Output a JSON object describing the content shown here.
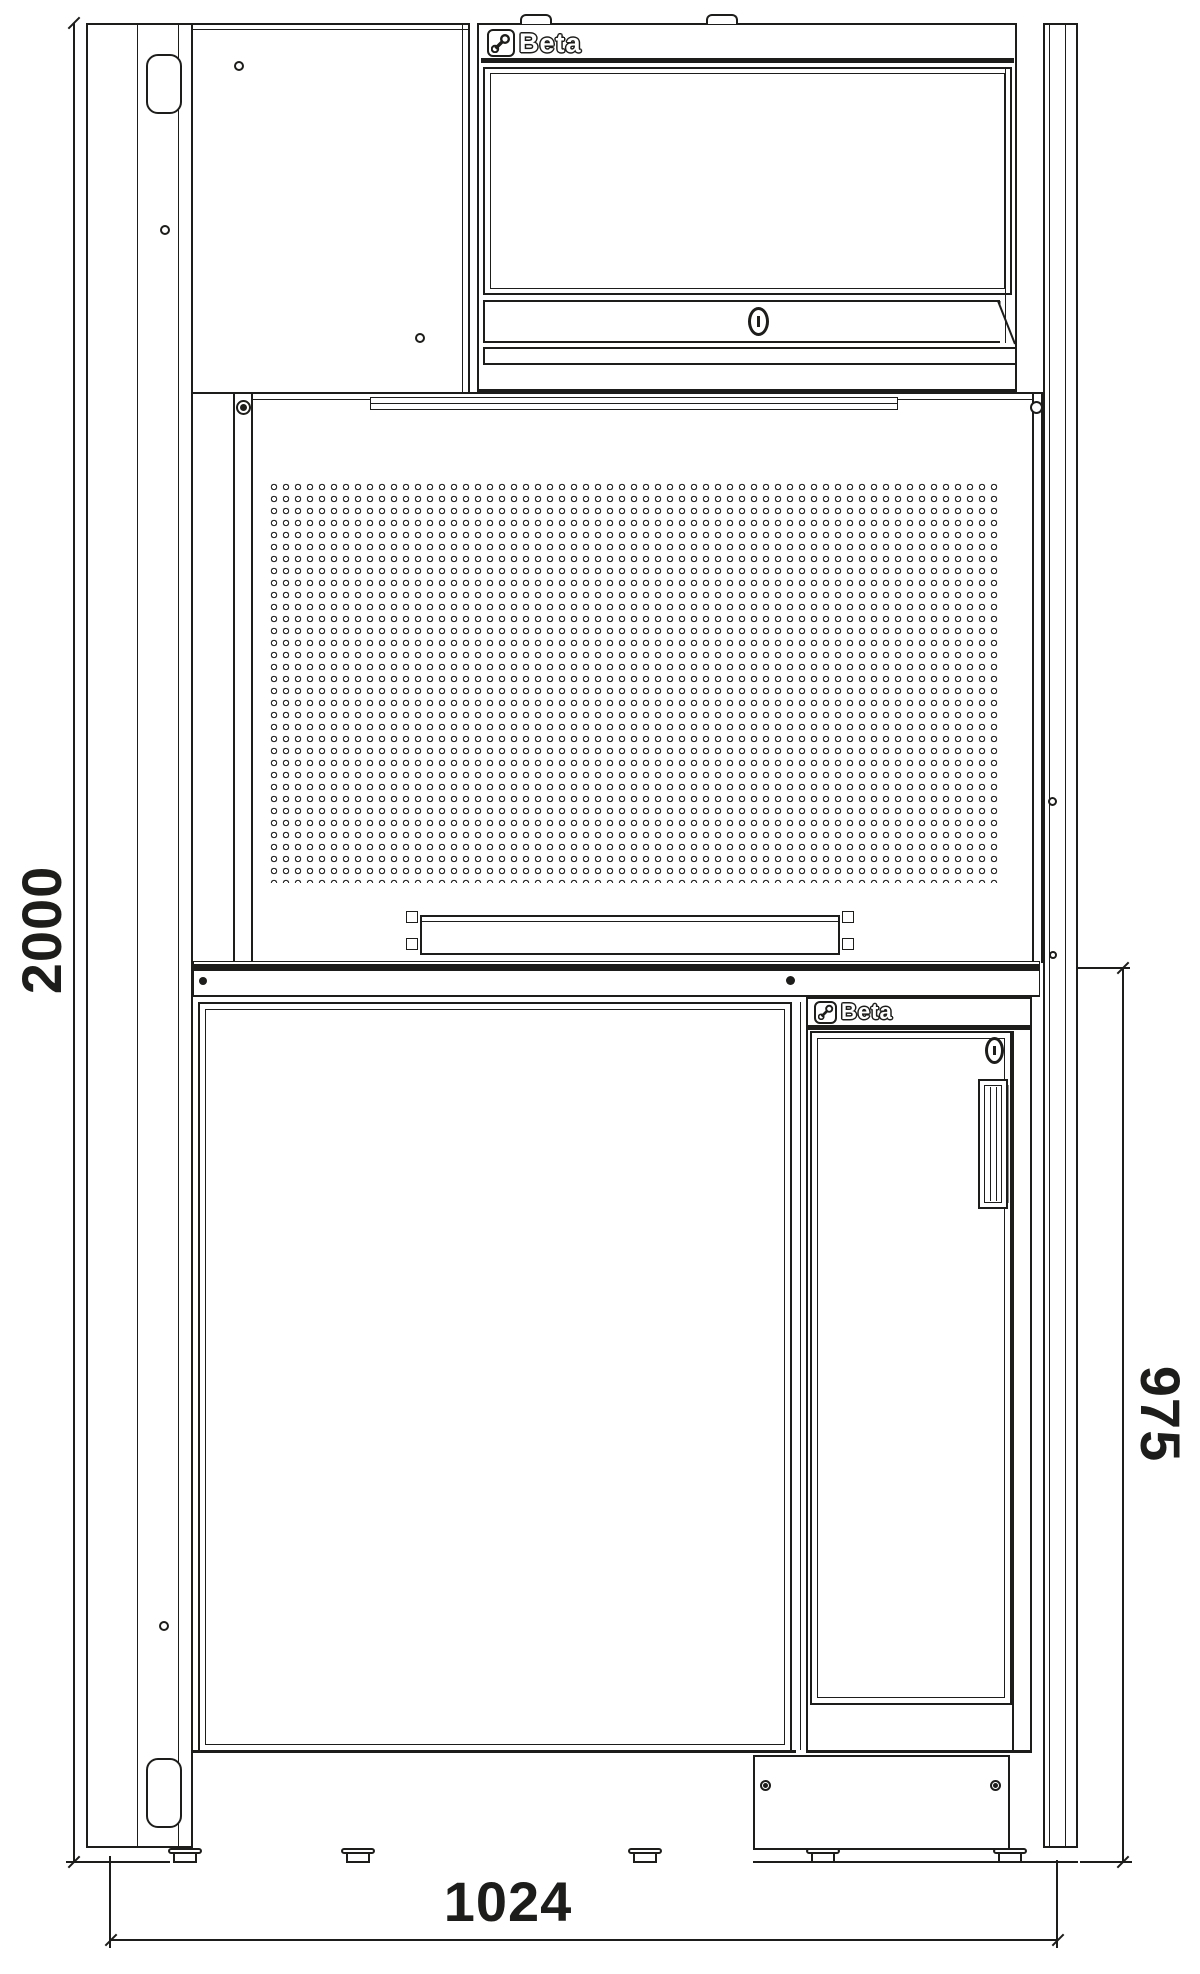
{
  "drawing": {
    "kind": "technical front-view line drawing of a Beta workshop combination unit (wall cabinet, open shelf, perforated tool panel, workbench top, base cabinets)"
  },
  "dimensions": {
    "overall_height_mm": "2000",
    "overall_width_mm": "1024",
    "bench_unit_height_mm": "975"
  },
  "brand": {
    "name": "Beta",
    "wall_cabinet_logo": "Beta",
    "base_cabinet_logo": "Beta"
  },
  "colors": {
    "ink": "#1d1d1b",
    "background": "#ffffff"
  }
}
